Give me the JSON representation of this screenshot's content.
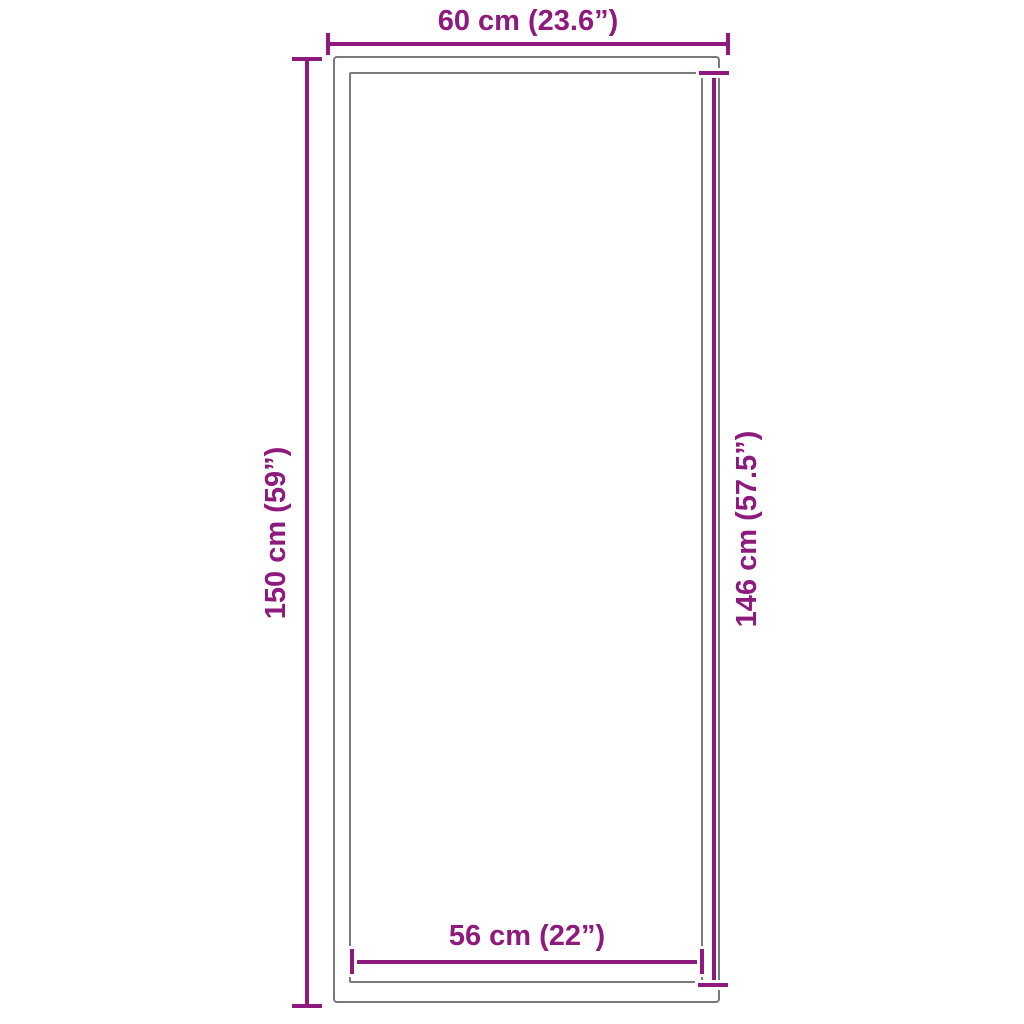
{
  "title": "Product dimensions diagram",
  "colors": {
    "accent": "#8E1A7D",
    "outline": "#7a7a7a",
    "background": "#ffffff"
  },
  "dimensions": {
    "top": {
      "label": "60 cm (23.6”)",
      "value_cm": 60,
      "value_in": 23.6
    },
    "left": {
      "label": "150 cm (59”)",
      "value_cm": 150,
      "value_in": 59
    },
    "right": {
      "label": "146 cm (57.5”)",
      "value_cm": 146,
      "value_in": 57.5
    },
    "bottom": {
      "label": "56 cm (22”)",
      "value_cm": 56,
      "value_in": 22
    }
  }
}
